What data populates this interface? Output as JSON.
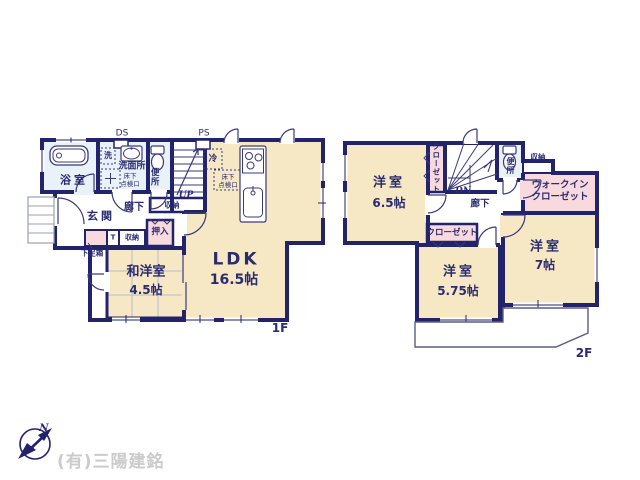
{
  "title": "間取り図",
  "floor1": {
    "label": "1F",
    "duct_space": "DS",
    "pipe_space": "PS",
    "rooms": {
      "bathroom": "浴室",
      "washroom": "洗面所",
      "toilet": "便所",
      "entrance": "玄関",
      "hallway": "廊下",
      "tatami_room_name": "和洋室",
      "tatami_room_size": "4.5帖",
      "ldk_name": "LDK",
      "ldk_size": "16.5帖"
    },
    "features": {
      "washer": "洗",
      "underfloor_hatch_line1": "床下",
      "underfloor_hatch_line2": "点検口",
      "fridge": "冷",
      "stairs_up": "UP",
      "stairs_storage": "収納",
      "closet_oshiire": "押入",
      "shoe_box": "下足箱",
      "t_unit": "T",
      "small_storage": "収納",
      "ldk_underfloor_line1": "床下",
      "ldk_underfloor_line2": "点検口"
    }
  },
  "floor2": {
    "label": "2F",
    "rooms": {
      "bedroom_a_name": "洋室",
      "bedroom_a_size": "6.5帖",
      "bedroom_b_name": "洋室",
      "bedroom_b_size": "5.75帖",
      "bedroom_c_name": "洋室",
      "bedroom_c_size": "7帖",
      "hallway": "廊下",
      "toilet": "便所",
      "walkin_closet_line1": "ウォークイン",
      "walkin_closet_line2": "クローゼット"
    },
    "features": {
      "closet_a": "クローゼット",
      "closet_b": "クローゼット",
      "storage": "収納",
      "stairs_down": "DN"
    }
  },
  "footer": {
    "company": "(有)三陽建銘",
    "compass_north": "N"
  },
  "colors": {
    "wall_navy": "#23236B",
    "floor_cream": "#F7E8C5",
    "closet_pink": "#F8D9DE",
    "wet_blue": "#EAF2F9",
    "text_navy": "#2B2B70",
    "company_gray": "#CBCBCB"
  }
}
